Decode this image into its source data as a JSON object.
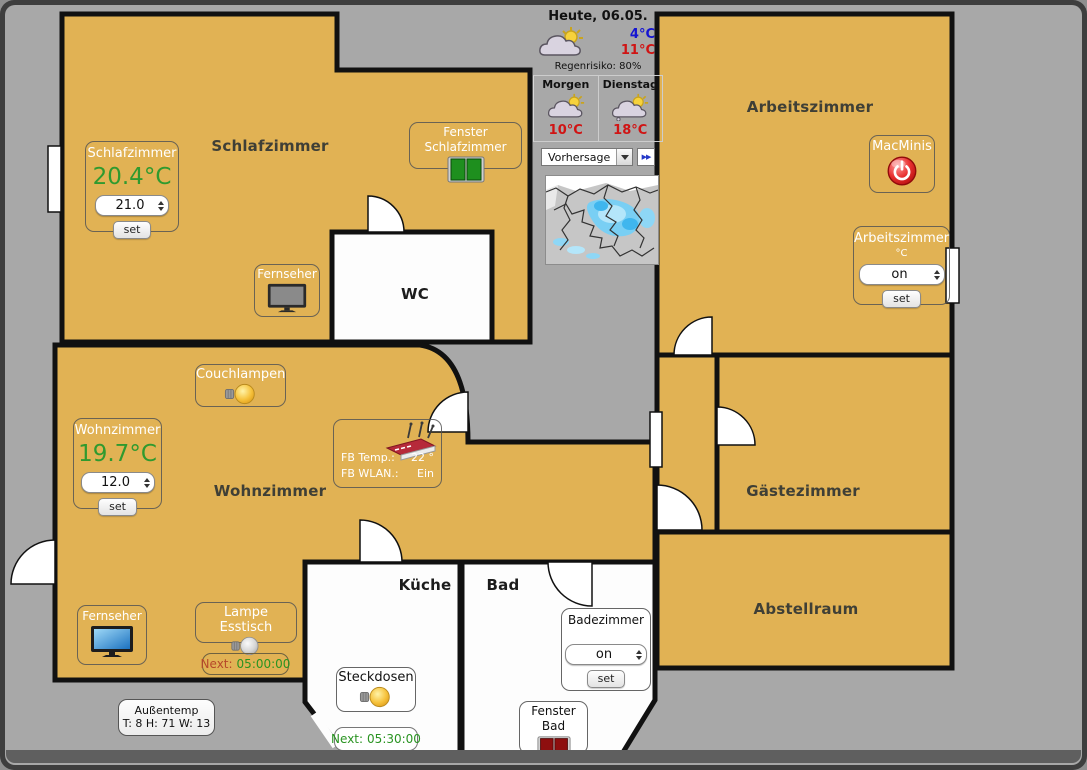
{
  "weather": {
    "today_label": "Heute, 06.05.",
    "today_min": "4°C",
    "today_max": "11°C",
    "rain_risk": "Regenrisiko: 80%",
    "forecast": [
      {
        "label": "Morgen",
        "temp": "10°C"
      },
      {
        "label": "Dienstag",
        "temp": "18°C"
      }
    ],
    "dropdown_value": "Vorhersage",
    "forward_button": "▶▶"
  },
  "rooms": {
    "schlafzimmer": "Schlafzimmer",
    "wc": "WC",
    "arbeitszimmer": "Arbeitszimmer",
    "wohnzimmer": "Wohnzimmer",
    "kueche": "Küche",
    "bad": "Bad",
    "gaestezimmer": "Gästezimmer",
    "abstellraum": "Abstellraum"
  },
  "panels": {
    "schlafzimmer_thermostat": {
      "title": "Schlafzimmer",
      "current": "20.4°C",
      "setpoint": "21.0",
      "set": "set"
    },
    "fenster_schlafzimmer": {
      "label": "Fenster Schlafzimmer"
    },
    "fernseher_schlafzimmer": {
      "label": "Fernseher"
    },
    "macminis": {
      "label": "MacMinis"
    },
    "arbeitszimmer_control": {
      "title": "Arbeitszimmer",
      "unit": "°C",
      "value": "on",
      "set": "set"
    },
    "couchlampen": {
      "label": "Couchlampen"
    },
    "wohnzimmer_thermostat": {
      "title": "Wohnzimmer",
      "current": "19.7°C",
      "setpoint": "12.0",
      "set": "set"
    },
    "fritzbox": {
      "temp_label": "FB Temp.:",
      "temp_value": "22 °",
      "wlan_label": "FB WLAN.:",
      "wlan_value": "Ein"
    },
    "fernseher_wohnzimmer": {
      "label": "Fernseher"
    },
    "lampe_esstisch": {
      "label": "Lampe Esstisch",
      "next_label": "Next:",
      "next_value": "05:00:00"
    },
    "steckdosen": {
      "label": "Steckdosen",
      "next_label": "Next:",
      "next_value": "05:30:00"
    },
    "badezimmer_control": {
      "title": "Badezimmer",
      "value": "on",
      "set": "set"
    },
    "fenster_bad": {
      "label": "Fenster Bad"
    },
    "aussentemp": {
      "title": "Außentemp",
      "values": "T: 8 H: 71 W: 13"
    }
  },
  "colors": {
    "room_fill": "#e1b254",
    "background": "#a8a8a8",
    "wall": "#111111",
    "temp_green": "#2f9a2f",
    "cold_blue": "#1414d2",
    "warm_red": "#d01414",
    "window_closed_green": "#1e8f1e",
    "window_open_red": "#8e0f0f"
  }
}
